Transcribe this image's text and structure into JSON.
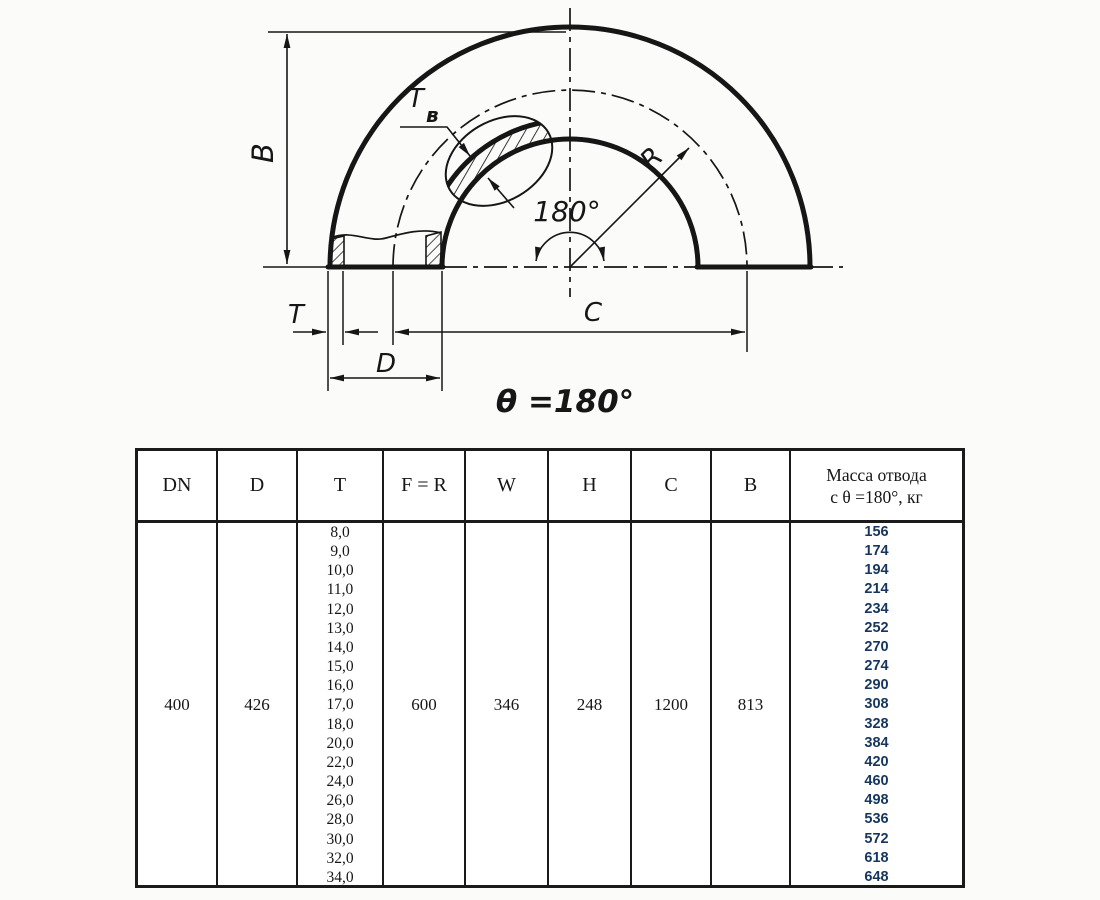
{
  "drawing": {
    "labels": {
      "height_b": "B",
      "wall_t": "T",
      "wall_tb_main": "T",
      "wall_tb_sub": "в",
      "radius_r": "R",
      "angle_arc": "180°",
      "diameter_d": "D",
      "length_c": "C",
      "theta_note": "θ =180°"
    }
  },
  "table": {
    "headers": [
      "DN",
      "D",
      "T",
      "F = R",
      "W",
      "H",
      "C",
      "B"
    ],
    "mass_header_line1": "Масса отвода",
    "mass_header_line2": "с θ =180°, кг",
    "values": {
      "dn": "400",
      "d": "426",
      "f_r": "600",
      "w": "346",
      "h": "248",
      "c": "1200",
      "b": "813"
    },
    "t_values": [
      "8,0",
      "9,0",
      "10,0",
      "11,0",
      "12,0",
      "13,0",
      "14,0",
      "15,0",
      "16,0",
      "17,0",
      "18,0",
      "20,0",
      "22,0",
      "24,0",
      "26,0",
      "28,0",
      "30,0",
      "32,0",
      "34,0"
    ],
    "mass_values": [
      "156",
      "174",
      "194",
      "214",
      "234",
      "252",
      "270",
      "274",
      "290",
      "308",
      "328",
      "384",
      "420",
      "460",
      "498",
      "536",
      "572",
      "618",
      "648"
    ],
    "mass_text_color": "#17365d",
    "line_color": "#1a1a1a"
  }
}
